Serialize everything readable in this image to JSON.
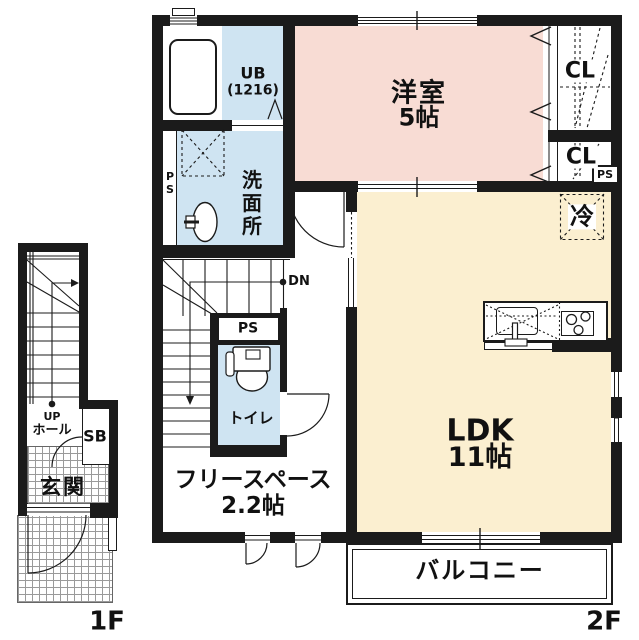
{
  "title": "apartment floor plan 1F/2F",
  "floors": {
    "f1": {
      "label": "1F"
    },
    "f2": {
      "label": "2F"
    }
  },
  "labels": {
    "ub_line1": "UB",
    "ub_line2": "(1216)",
    "washroom": "洗面所",
    "ps_vertical": "PS",
    "western_room_line1": "洋室",
    "western_room_line2": "5帖",
    "closet_upper": "CL",
    "closet_lower": "CL",
    "ps_corner": "PS",
    "fridge": "冷",
    "ldk_line1": "LDK",
    "ldk_line2": "11帖",
    "down": "DN",
    "ps_mid": "PS",
    "toilet": "トイレ",
    "free_space_line1": "フリースペース",
    "free_space_line2": "2.2帖",
    "balcony": "バルコニー",
    "up": "UP",
    "hall": "ホール",
    "shoe_box": "SB",
    "entrance": "玄関"
  },
  "colors": {
    "wall": "#1b1b1b",
    "western_room": "#f8dcd4",
    "ldk": "#fbefd0",
    "wet_area": "#cfe4f2"
  }
}
